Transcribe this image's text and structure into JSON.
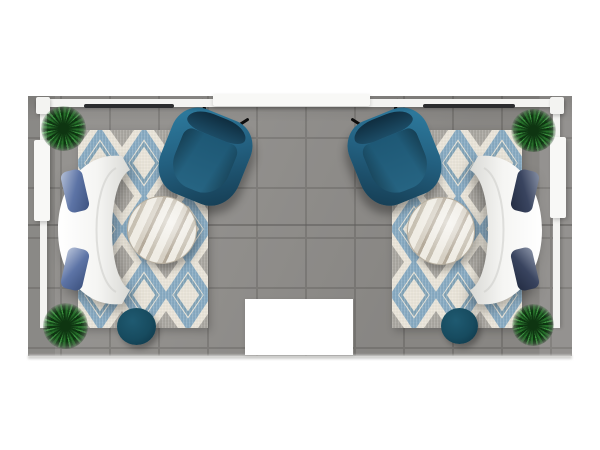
{
  "scene": {
    "colors": {
      "floor_base": "#8f8d8a",
      "floor_grout": "#7c7a77",
      "floor_seam": "#5f5d5b",
      "frame_white": "#f3f3f1",
      "header_white": "#f8f8f6",
      "fixture_dark": "#2b2c2e",
      "rug_cream": "#e9e4d8",
      "rug_blue": "#7ba3bf",
      "rug_blue_deep": "#5d8cab",
      "rug_gray": "#9d9a95",
      "sofa_white": "#f5f5f3",
      "pillow_left_a": "#b9c4da",
      "pillow_left_b": "#5d74a6",
      "pillow_left_c": "#3c517e",
      "pillow_right_a": "#8b94a8",
      "pillow_right_b": "#39445f",
      "pillow_right_c": "#232c42",
      "chair_teal": "#236080",
      "chair_teal_light": "#2f7fa3",
      "chair_teal_dark": "#14394e",
      "chair_back": "#0f2d3f",
      "table_base": "#d6d0c4",
      "table_streak": "#b4aa9a",
      "table_light": "#efece4",
      "ottoman": "#174b5f",
      "ottoman_dark": "#0e3445",
      "plant_light": "#3a8f3e",
      "plant_mid": "#256e29",
      "plant_dark": "#16491a",
      "plant_dark2": "#0e3511",
      "mat_white": "#ffffff"
    },
    "objects": {
      "floor": {
        "x": 28,
        "y": 96,
        "w": 544,
        "h": 260
      },
      "floor_seam": {
        "x": 28,
        "y": 224,
        "w": 544,
        "h": 2
      },
      "floor_edge": {
        "x": 28,
        "y": 355,
        "w": 544,
        "h": 4
      },
      "top_rail": {
        "x": 36,
        "y": 99,
        "w": 528,
        "h": 8
      },
      "top_header": {
        "x": 213,
        "y": 94,
        "w": 157,
        "h": 12
      },
      "post_left": {
        "x": 36,
        "y": 97,
        "w": 14,
        "h": 17
      },
      "post_right": {
        "x": 550,
        "y": 97,
        "w": 14,
        "h": 17
      },
      "light_bar_left": {
        "x": 84,
        "y": 104,
        "w": 90,
        "h": 4
      },
      "light_bar_right": {
        "x": 423,
        "y": 104,
        "w": 92,
        "h": 4
      },
      "rail_left": {
        "x": 40,
        "y": 106,
        "w": 7,
        "h": 222
      },
      "panel_left": {
        "x": 34,
        "y": 140,
        "w": 16,
        "h": 81
      },
      "rail_right": {
        "x": 553,
        "y": 106,
        "w": 7,
        "h": 222
      },
      "panel_right": {
        "x": 550,
        "y": 137,
        "w": 16,
        "h": 81
      },
      "rug_left": {
        "x": 78,
        "y": 130,
        "w": 130,
        "h": 198
      },
      "rug_right": {
        "x": 392,
        "y": 130,
        "w": 130,
        "h": 198
      },
      "sofa_left": {
        "x": 52,
        "y": 150,
        "w": 110,
        "h": 160
      },
      "sofa_right": {
        "x": 438,
        "y": 150,
        "w": 110,
        "h": 160,
        "flip": true
      },
      "chair_left": {
        "x": 163,
        "y": 112,
        "w": 84,
        "h": 90,
        "rot": 22
      },
      "chair_right": {
        "x": 353,
        "y": 112,
        "w": 84,
        "h": 90,
        "rot": 22,
        "flip": true
      },
      "table_left": {
        "x": 127,
        "y": 196,
        "w": 68,
        "h": 66
      },
      "table_right": {
        "x": 407,
        "y": 197,
        "w": 66,
        "h": 66
      },
      "ottoman_left": {
        "x": 117,
        "y": 308,
        "w": 39,
        "h": 37
      },
      "ottoman_right": {
        "x": 441,
        "y": 308,
        "w": 37,
        "h": 36
      },
      "plant_tl": {
        "x": 41,
        "y": 106,
        "w": 45,
        "h": 45
      },
      "plant_bl": {
        "x": 43,
        "y": 303,
        "w": 45,
        "h": 46
      },
      "plant_tr": {
        "x": 511,
        "y": 109,
        "w": 45,
        "h": 43
      },
      "plant_br": {
        "x": 512,
        "y": 304,
        "w": 42,
        "h": 42
      },
      "mat": {
        "x": 245,
        "y": 299,
        "w": 108,
        "h": 56
      }
    }
  }
}
